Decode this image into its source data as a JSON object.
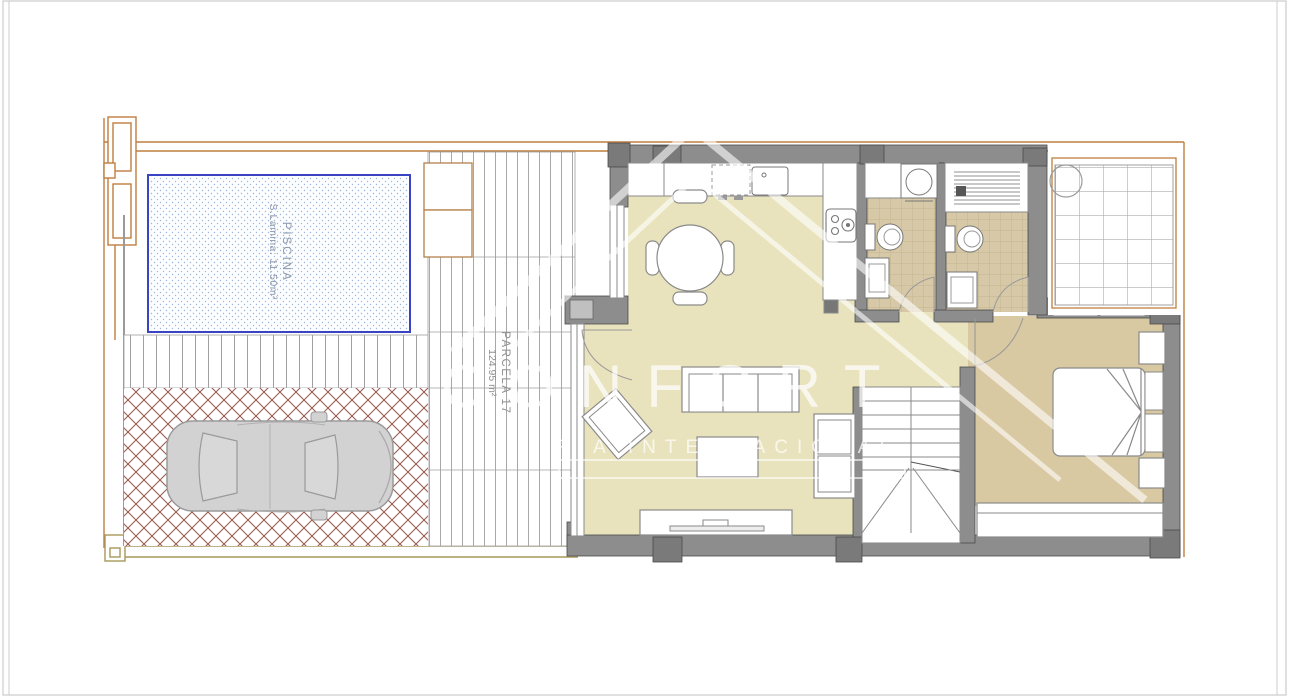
{
  "plan": {
    "pool": {
      "name": "PISCINA",
      "area": "S.Lamina: 11.50m²"
    },
    "parcel": {
      "name": "PARCELA 17",
      "area": "124.95 m²"
    }
  },
  "watermark": {
    "brand": "CONFORT",
    "tagline": "RIA INTERNACIONAL"
  },
  "colors": {
    "floor_main": "#e9e3bd",
    "floor_bedroom": "#d9c9a2",
    "bath_tile": "#d7c9a7",
    "wall": "#8d8d8d",
    "wall_pillar": "#7a7a7a",
    "boundary_orange": "#bf7e3f",
    "boundary_tan": "#a89858",
    "pool_border": "#3a43c4",
    "pool_dots": "#9fb6d8",
    "brick": "#9c5b52",
    "car_body": "#d2d2d2",
    "furniture_line": "#8a8a8a"
  }
}
